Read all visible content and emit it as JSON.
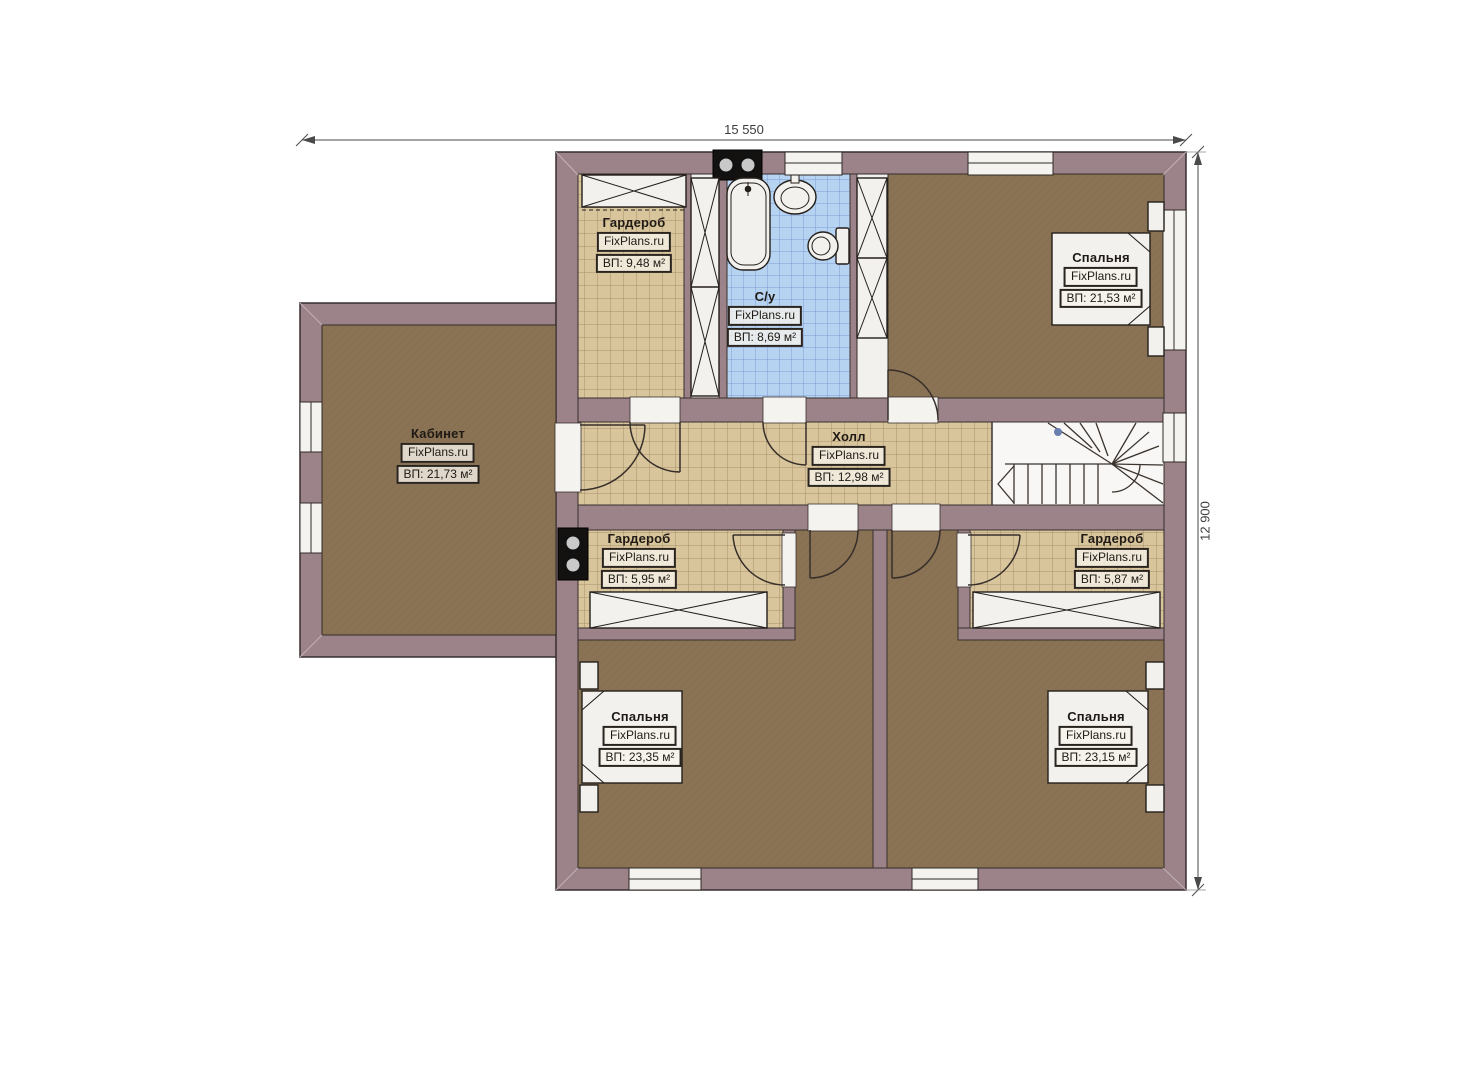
{
  "title": "Floor plan (second floor)",
  "site_watermark": "FixPlans.ru",
  "dimensions": {
    "width_label": "15 550",
    "height_label": "12 900"
  },
  "rooms": [
    {
      "id": "garderob-top-left",
      "name": "Гардероб",
      "site": "FixPlans.ru",
      "area": "ВП: 9,48 м²"
    },
    {
      "id": "su-bathroom",
      "name": "С/у",
      "site": "FixPlans.ru",
      "area": "ВП: 8,69 м²"
    },
    {
      "id": "bedroom-top-right",
      "name": "Спальня",
      "site": "FixPlans.ru",
      "area": "ВП: 21,53 м²"
    },
    {
      "id": "kabinet",
      "name": "Кабинет",
      "site": "FixPlans.ru",
      "area": "ВП: 21,73 м²"
    },
    {
      "id": "holl",
      "name": "Холл",
      "site": "FixPlans.ru",
      "area": "ВП: 12,98 м²"
    },
    {
      "id": "garderob-mid-left",
      "name": "Гардероб",
      "site": "FixPlans.ru",
      "area": "ВП: 5,95 м²"
    },
    {
      "id": "garderob-mid-right",
      "name": "Гардероб",
      "site": "FixPlans.ru",
      "area": "ВП: 5,87 м²"
    },
    {
      "id": "bedroom-bottom-left",
      "name": "Спальня",
      "site": "FixPlans.ru",
      "area": "ВП: 23,35 м²"
    },
    {
      "id": "bedroom-bottom-right",
      "name": "Спальня",
      "site": "FixPlans.ru",
      "area": "ВП: 23,15 м²"
    }
  ],
  "colors": {
    "wall": "#9c8289",
    "floor_brown": "#8a7254",
    "tile_beige": "#d9c59c",
    "tile_blue": "#b7d3f2",
    "furniture_white": "#f2f1ee",
    "outline": "#38302c"
  }
}
